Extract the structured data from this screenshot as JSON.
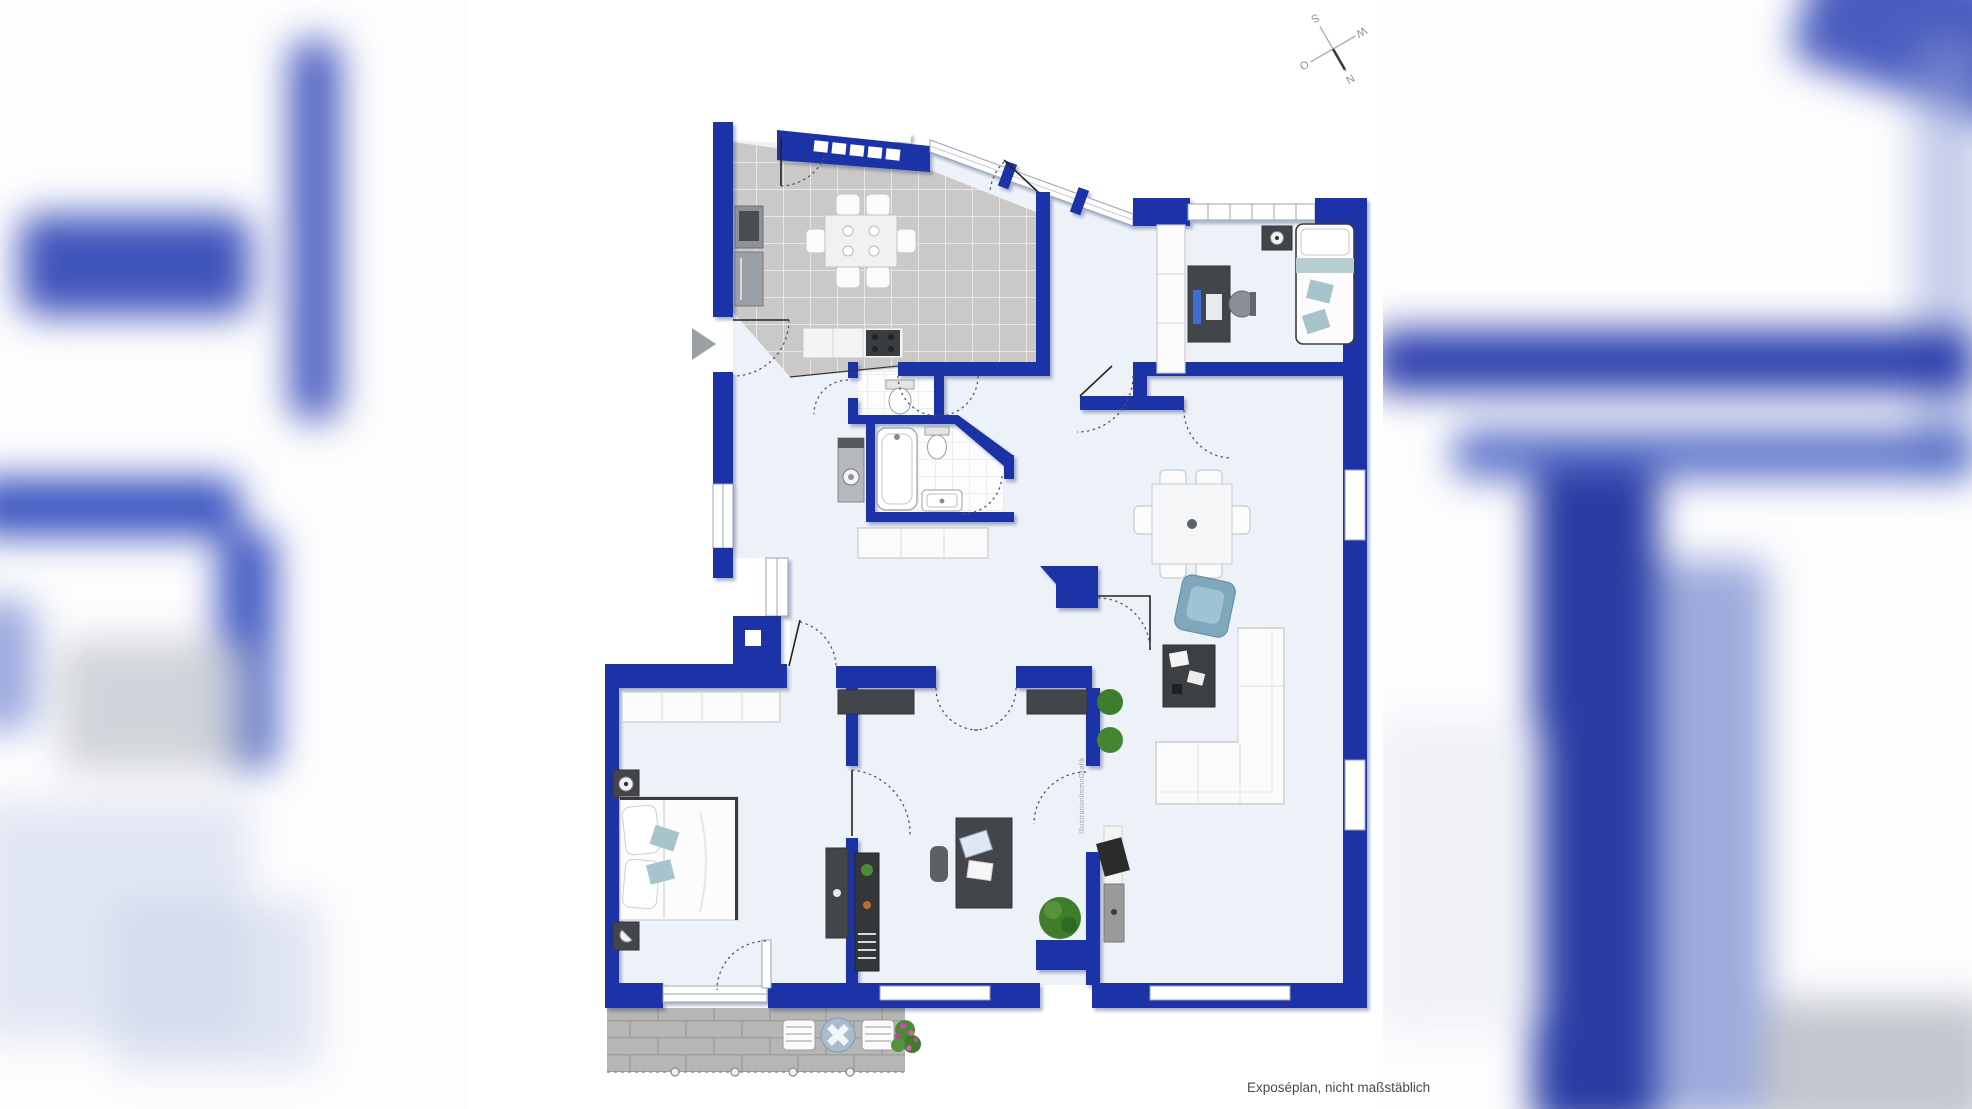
{
  "canvas": {
    "width": 1972,
    "height": 1109
  },
  "footer": {
    "note": "Exposéplan, nicht maßstäblich"
  },
  "compass": {
    "north": "N",
    "east": "O",
    "south": "S",
    "west": "W"
  },
  "watermark": {
    "text": "IllustrationImmoGrafik"
  },
  "colors": {
    "wall_blue": "#1b33a7",
    "floor_light": "#edf2f9",
    "kitchen_tile": "#cac9c7",
    "terrace_paver": "#b6b6b4",
    "textile_accent": "#a7c3cc",
    "armchair_teal": "#7fa8bd",
    "furniture_dark": "#42464b",
    "plant_green": "#4c8a38",
    "flower_pink": "#cf4aa8"
  }
}
